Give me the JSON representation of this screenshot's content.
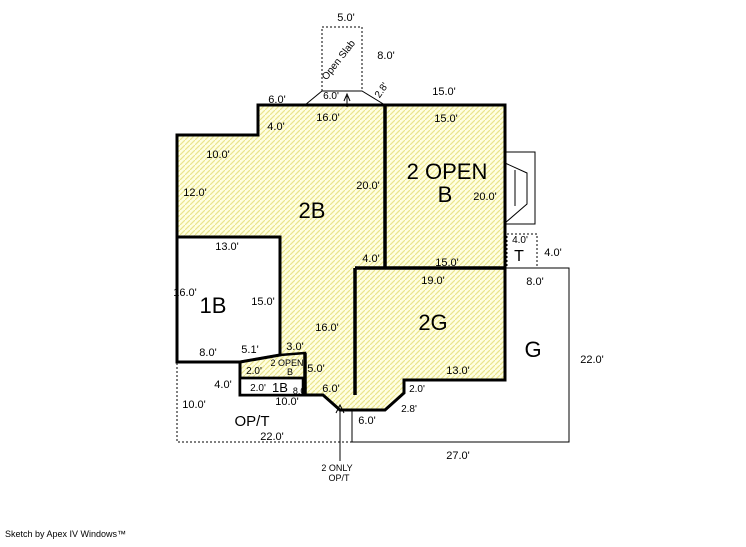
{
  "footer": {
    "credit": "Sketch by Apex IV Windows™"
  },
  "colors": {
    "wall": "#000000",
    "hatch_bg": "#FFFFE2",
    "hatch_line": "#EAE58C",
    "open_fill": "#FFFFFF",
    "background": "#FFFFFF"
  },
  "areas": [
    {
      "name": "2B",
      "fill": "hatched"
    },
    {
      "name": "2 OPEN B",
      "fill": "hatched"
    },
    {
      "name": "1B",
      "fill": "open"
    },
    {
      "name": "2G",
      "fill": "hatched"
    },
    {
      "name": "G",
      "fill": "open"
    },
    {
      "name": "T",
      "fill": "open"
    },
    {
      "name": "OP/T",
      "fill": "open"
    },
    {
      "name": "Open Slab",
      "fill": "open"
    },
    {
      "name": "1B (lower strip)",
      "fill": "open"
    },
    {
      "name": "2 OPEN B (lower)",
      "fill": "hatched"
    },
    {
      "name": "2 ONLY OP/T",
      "fill": "note"
    }
  ],
  "labels": [
    {
      "t": "5.0'",
      "x": 346,
      "y": 21
    },
    {
      "t": "8.0'",
      "x": 386,
      "y": 59
    },
    {
      "t": "Open Slab",
      "x": 341,
      "y": 62,
      "s": 10,
      "r": -52,
      "n": "open-slab-label"
    },
    {
      "t": "6.0'",
      "x": 277,
      "y": 103
    },
    {
      "t": "6.0'",
      "x": 331,
      "y": 99,
      "s": 10
    },
    {
      "t": "2.8'",
      "x": 384,
      "y": 92,
      "s": 10,
      "r": -55
    },
    {
      "t": "15.0'",
      "x": 444,
      "y": 95
    },
    {
      "t": "16.0'",
      "x": 328,
      "y": 121
    },
    {
      "t": "15.0'",
      "x": 446,
      "y": 122
    },
    {
      "t": "4.0'",
      "x": 276,
      "y": 130
    },
    {
      "t": "10.0'",
      "x": 218,
      "y": 158
    },
    {
      "t": "12.0'",
      "x": 195,
      "y": 196
    },
    {
      "t": "20.0'",
      "x": 368,
      "y": 189
    },
    {
      "t": "2B",
      "x": 312,
      "y": 218,
      "s": 22,
      "n": "area-label-2b"
    },
    {
      "t": "2 OPEN",
      "x": 447,
      "y": 179,
      "s": 22,
      "n": "area-label-2openb"
    },
    {
      "t": "B",
      "x": 445,
      "y": 202,
      "s": 22,
      "n": "area-label-2openb"
    },
    {
      "t": "20.0'",
      "x": 485,
      "y": 200
    },
    {
      "t": "13.0'",
      "x": 227,
      "y": 250
    },
    {
      "t": "16.0'",
      "x": 185,
      "y": 296
    },
    {
      "t": "1B",
      "x": 213,
      "y": 313,
      "s": 22,
      "n": "area-label-1b"
    },
    {
      "t": "15.0'",
      "x": 263,
      "y": 305
    },
    {
      "t": "16.0'",
      "x": 327,
      "y": 331
    },
    {
      "t": "8.0'",
      "x": 208,
      "y": 356
    },
    {
      "t": "5.1'",
      "x": 250,
      "y": 353
    },
    {
      "t": "3.0'",
      "x": 295,
      "y": 350
    },
    {
      "t": "2.0'",
      "x": 254,
      "y": 374,
      "s": 10
    },
    {
      "t": "2 OPEN",
      "x": 287,
      "y": 366,
      "s": 9,
      "n": "area-label-2openb-small"
    },
    {
      "t": "B",
      "x": 290,
      "y": 375,
      "s": 9,
      "n": "area-label-2openb-small"
    },
    {
      "t": "5.0'",
      "x": 316,
      "y": 372
    },
    {
      "t": "4.0'",
      "x": 223,
      "y": 388
    },
    {
      "t": "2.0'",
      "x": 258,
      "y": 391,
      "s": 10
    },
    {
      "t": "1B",
      "x": 280,
      "y": 392,
      "s": 13,
      "n": "area-label-1b-small"
    },
    {
      "t": "8.0'",
      "x": 300,
      "y": 394,
      "s": 9
    },
    {
      "t": "6.0'",
      "x": 331,
      "y": 392
    },
    {
      "t": "10.0'",
      "x": 287,
      "y": 405
    },
    {
      "t": "10.0'",
      "x": 194,
      "y": 408
    },
    {
      "t": "OP/T",
      "x": 252,
      "y": 426,
      "s": 15,
      "n": "area-label-opt"
    },
    {
      "t": "22.0'",
      "x": 272,
      "y": 440
    },
    {
      "t": "15.0'",
      "x": 447,
      "y": 266
    },
    {
      "t": "4.0'",
      "x": 371,
      "y": 262
    },
    {
      "t": "19.0'",
      "x": 433,
      "y": 284
    },
    {
      "t": "2G",
      "x": 433,
      "y": 330,
      "s": 22,
      "n": "area-label-2g"
    },
    {
      "t": "13.0'",
      "x": 458,
      "y": 374
    },
    {
      "t": "2.0'",
      "x": 417,
      "y": 392,
      "s": 10
    },
    {
      "t": "2.8'",
      "x": 409,
      "y": 412,
      "s": 10
    },
    {
      "t": "6.0'",
      "x": 367,
      "y": 424
    },
    {
      "t": "4.0'",
      "x": 520,
      "y": 243,
      "s": 10
    },
    {
      "t": "T",
      "x": 519,
      "y": 261,
      "s": 16,
      "n": "area-label-t"
    },
    {
      "t": "4.0'",
      "x": 553,
      "y": 256
    },
    {
      "t": "8.0'",
      "x": 535,
      "y": 285
    },
    {
      "t": "G",
      "x": 533,
      "y": 357,
      "s": 22,
      "n": "area-label-g"
    },
    {
      "t": "22.0'",
      "x": 592,
      "y": 363
    },
    {
      "t": "27.0'",
      "x": 458,
      "y": 459
    },
    {
      "t": "2 ONLY",
      "x": 337,
      "y": 471,
      "s": 9,
      "n": "note-2-only-opt"
    },
    {
      "t": "OP/T",
      "x": 339,
      "y": 481,
      "s": 9,
      "n": "note-2-only-opt"
    }
  ]
}
